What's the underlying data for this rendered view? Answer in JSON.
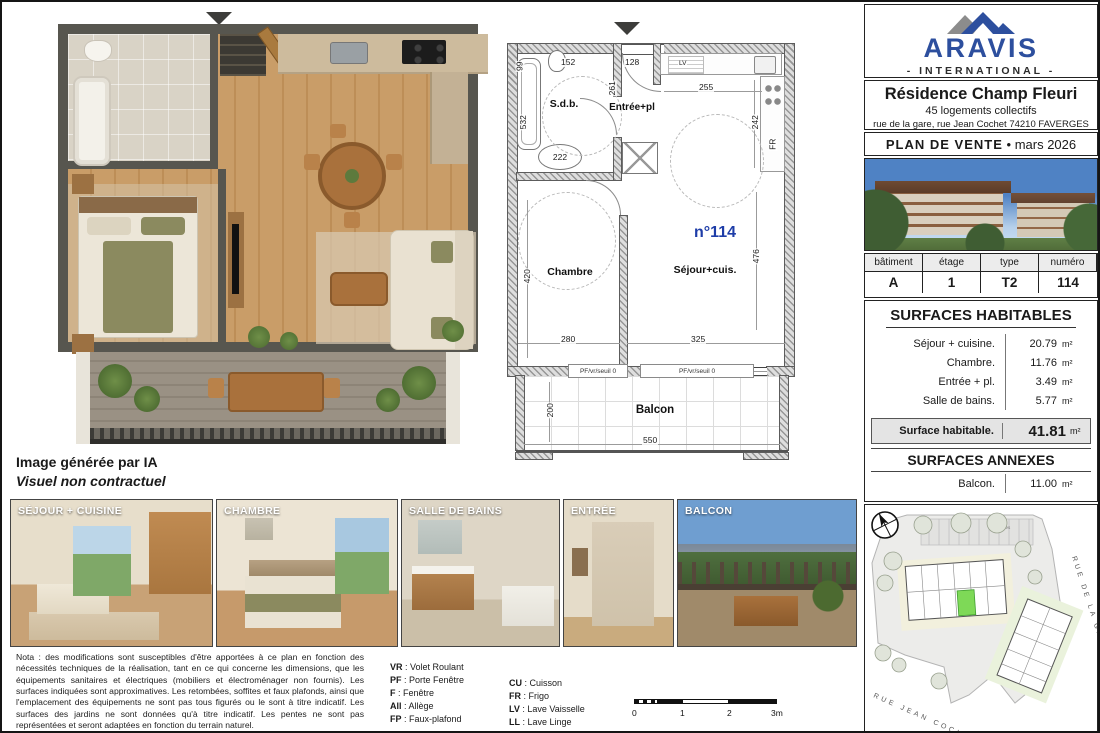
{
  "brand": {
    "name": "ARAVIS",
    "tagline": "- INTERNATIONAL -",
    "accent_blue": "#2d4f9e"
  },
  "project": {
    "title": "Résidence Champ Fleuri",
    "subtitle": "45 logements collectifs",
    "address": "rue de la gare, rue Jean Cochet 74210 FAVERGES",
    "doc_type": "PLAN DE VENTE",
    "doc_date": "mars 2026"
  },
  "unit": {
    "headers": [
      "bâtiment",
      "étage",
      "type",
      "numéro"
    ],
    "values": [
      "A",
      "1",
      "T2",
      "114"
    ]
  },
  "surfaces": {
    "title": "SURFACES HABITABLES",
    "rows": [
      {
        "label": "Séjour + cuisine.",
        "value": "20.79",
        "unit": "m²"
      },
      {
        "label": "Chambre.",
        "value": "11.76",
        "unit": "m²"
      },
      {
        "label": "Entrée + pl.",
        "value": "3.49",
        "unit": "m²"
      },
      {
        "label": "Salle de bains.",
        "value": "5.77",
        "unit": "m²"
      }
    ],
    "total": {
      "label": "Surface habitable.",
      "value": "41.81",
      "unit": "m²"
    },
    "annexes_title": "SURFACES ANNEXES",
    "annexes": [
      {
        "label": "Balcon.",
        "value": "11.00",
        "unit": "m²"
      }
    ]
  },
  "plan": {
    "unit_number": "n°114",
    "rooms": {
      "sdb": "S.d.b.",
      "entree": "Entrée+pl",
      "chambre": "Chambre",
      "sejour": "Séjour+cuis.",
      "balcon": "Balcon"
    },
    "dims": {
      "d99": "99",
      "d152": "152",
      "d128": "128",
      "d261": "261",
      "d532": "532",
      "d222": "222",
      "d255": "255",
      "d242": "242",
      "d420": "420",
      "d280": "280",
      "d325": "325",
      "d476": "476",
      "d200": "200",
      "d550": "550"
    },
    "labels": {
      "fr": "FR",
      "lv": "LV",
      "window": "PF/vr/seuil 0"
    }
  },
  "ai_note": {
    "line1": "Image générée par IA",
    "line2": "Visuel non contractuel"
  },
  "photos": [
    {
      "caption": "SÉJOUR + CUISINE"
    },
    {
      "caption": "CHAMBRE"
    },
    {
      "caption": "SALLE DE BAINS"
    },
    {
      "caption": "ENTRÉE"
    },
    {
      "caption": "BALCON"
    }
  ],
  "nota": "Nota : des modifications sont susceptibles d'être apportées à ce plan en fonction des nécessités techniques de la réalisation, tant en ce qui concerne les dimensions, que les équipements sanitaires et électriques (mobiliers et électroménager non fournis). Les surfaces indiquées sont approximatives. Les retombées, soffites et faux plafonds, ainsi que l'emplacement des équipements ne sont pas tous figurés ou le sont à titre indicatif. Les surfaces des jardins ne sont données qu'à titre indicatif. Les pentes ne sont pas représentées et seront adaptées en fonction du terrain naturel.",
  "legend": {
    "col1": [
      {
        "abbr": "VR",
        "label": "Volet Roulant"
      },
      {
        "abbr": "PF",
        "label": "Porte Fenêtre"
      },
      {
        "abbr": "F",
        "label": "Fenêtre"
      },
      {
        "abbr": "All",
        "label": "Allège"
      },
      {
        "abbr": "FP",
        "label": "Faux-plafond"
      }
    ],
    "col2": [
      {
        "abbr": "CU",
        "label": "Cuisson"
      },
      {
        "abbr": "FR",
        "label": "Frigo"
      },
      {
        "abbr": "LV",
        "label": "Lave Vaisselle"
      },
      {
        "abbr": "LL",
        "label": "Lave Linge"
      }
    ],
    "tableau_label": "Tableau Elec."
  },
  "scale": {
    "t0": "0",
    "t1": "1",
    "t2": "2",
    "t3": "3m"
  },
  "site": {
    "street_gare": "RUE DE LA GARE",
    "street_cochet": "RUE JEAN COCHET",
    "parking": "30 places"
  }
}
